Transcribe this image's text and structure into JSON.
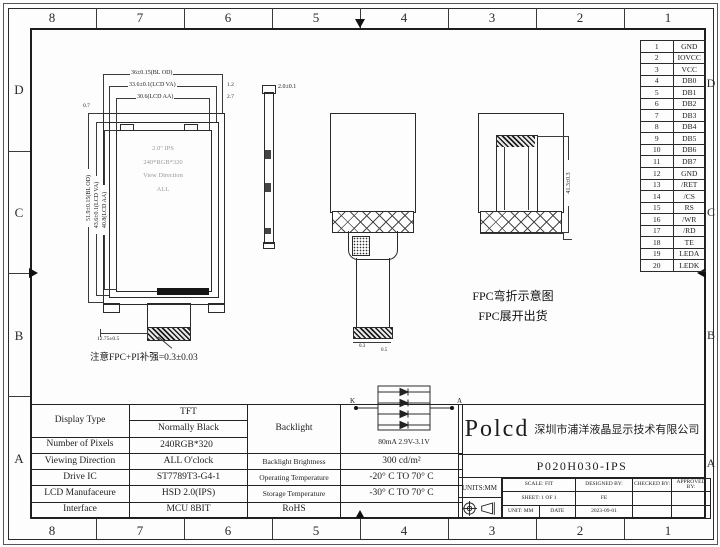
{
  "sheet": {
    "cols": [
      "8",
      "7",
      "6",
      "5",
      "4",
      "3",
      "2",
      "1"
    ],
    "rows": [
      "D",
      "C",
      "B",
      "A"
    ]
  },
  "pins": {
    "rows": [
      {
        "no": "1",
        "name": "GND"
      },
      {
        "no": "2",
        "name": "IOVCC"
      },
      {
        "no": "3",
        "name": "VCC"
      },
      {
        "no": "4",
        "name": "DB0"
      },
      {
        "no": "5",
        "name": "DB1"
      },
      {
        "no": "6",
        "name": "DB2"
      },
      {
        "no": "7",
        "name": "DB3"
      },
      {
        "no": "8",
        "name": "DB4"
      },
      {
        "no": "9",
        "name": "DB5"
      },
      {
        "no": "10",
        "name": "DB6"
      },
      {
        "no": "11",
        "name": "DB7"
      },
      {
        "no": "12",
        "name": "GND"
      },
      {
        "no": "13",
        "name": "/RET"
      },
      {
        "no": "14",
        "name": "/CS"
      },
      {
        "no": "15",
        "name": "RS"
      },
      {
        "no": "16",
        "name": "/WR"
      },
      {
        "no": "17",
        "name": "/RD"
      },
      {
        "no": "18",
        "name": "TE"
      },
      {
        "no": "19",
        "name": "LEDA"
      },
      {
        "no": "20",
        "name": "LEDK"
      }
    ]
  },
  "front_view": {
    "dim_outline_w": "36±0.15(BL OD)",
    "dim_va_w": "33.6±0.1(LCD VA)",
    "dim_aa_w": "30.6(LCD AA)",
    "dim_margin_va": "1.2",
    "dim_margin_aa": "2.7",
    "dim_top_margin": "0.7",
    "dim_outline_h": "51.9±0.15(BL OD)",
    "dim_va_h": "43.6±0.1(LCD VA)",
    "dim_aa_h": "40.8(LCD AA)",
    "panel_line1": "2.0\" IPS",
    "panel_line2": "240*RGB*320",
    "panel_line3": "View Direction",
    "panel_line4": "ALL",
    "dim_fpc_width": "12.75±0.5",
    "note": "注意FPC+PI补强=0.3±0.03"
  },
  "side_view": {
    "dim_thickness": "2.0±0.1"
  },
  "unfolded_view": {
    "dim_a": "0.3",
    "dim_b": "0.5"
  },
  "folded_view": {
    "dim_height": "41.3±0.3",
    "caption1": "FPC弯折示意图",
    "caption2": "FPC展开出货"
  },
  "backlight": {
    "k": "K",
    "a": "A",
    "caption": "80mA  2.9V-3.1V"
  },
  "spec_table": {
    "display_type_label": "Display Type",
    "display_type_1": "TFT",
    "display_type_2": "Normally Black",
    "pixels_label": "Number of Pixels",
    "pixels": "240RGB*320",
    "viewing_label": "Viewing Direction",
    "viewing": "ALL O'clock",
    "ic_label": "Drive IC",
    "ic": "ST7789T3-G4-1",
    "mfr_label": "LCD Manufaceure",
    "mfr": "HSD 2.0(IPS)",
    "iface_label": "Interface",
    "iface": "MCU 8BIT",
    "backlight_label": "Backlight",
    "brightness_label": "Backlight Brightness",
    "brightness": "300 cd/m²",
    "op_temp_label": "Operating Temperature",
    "op_temp": "-20° C TO 70° C",
    "st_temp_label": "Storage Temperature",
    "st_temp": "-30° C TO 70° C",
    "rohs_label": "RoHS"
  },
  "title_block": {
    "logo": "Polcd",
    "company": "深圳市浦洋液晶显示技术有限公司",
    "part_number": "P020H030-IPS",
    "units": "UNITS:MM",
    "scale": "SCALE: FIT",
    "sheet": "SHEET: 1 OF 1",
    "unit": "UNIT: MM",
    "date_label": "DATE",
    "date": "2023-09-01",
    "designed_label": "DESIGNED BY:",
    "designed": "FE",
    "checked_label": "CHECKED BY:",
    "approved_label": "APPROVED BY:"
  }
}
